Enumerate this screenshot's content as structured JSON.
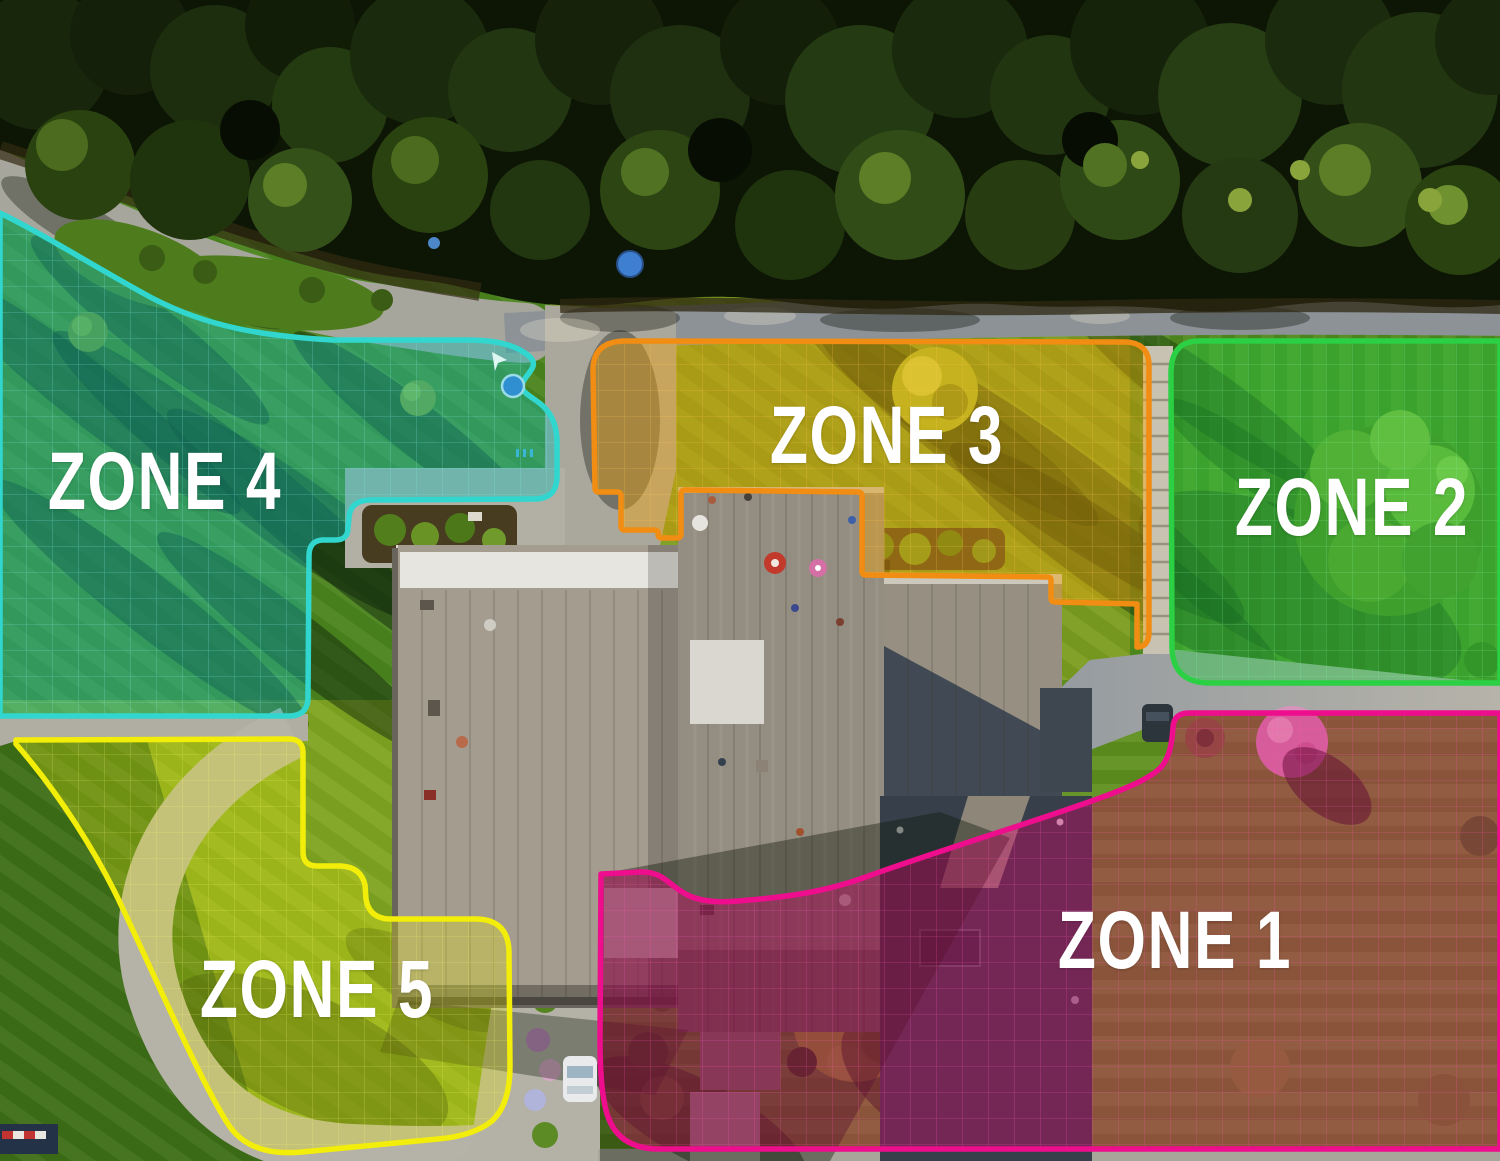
{
  "zones": [
    {
      "id": "zone-1",
      "label": "ZONE 1",
      "border_color": "#ee0d8d",
      "fill_color": "rgba(216,0,106,0.38)",
      "grid_color": "#ff55b5"
    },
    {
      "id": "zone-2",
      "label": "ZONE 2",
      "border_color": "#2bd044",
      "fill_color": "rgba(38,205,70,0.42)",
      "grid_color": "#7df29a"
    },
    {
      "id": "zone-3",
      "label": "ZONE 3",
      "border_color": "#f18d12",
      "fill_color": "rgba(240,163,6,0.42)",
      "grid_color": "#ffc654"
    },
    {
      "id": "zone-4",
      "label": "ZONE 4",
      "border_color": "#31d7cf",
      "fill_color": "rgba(22,189,182,0.42)",
      "grid_color": "#7fe9e3"
    },
    {
      "id": "zone-5",
      "label": "ZONE 5",
      "border_color": "#f3ed0a",
      "fill_color": "rgba(233,233,12,0.30)",
      "grid_color": "#fbf76a"
    }
  ]
}
